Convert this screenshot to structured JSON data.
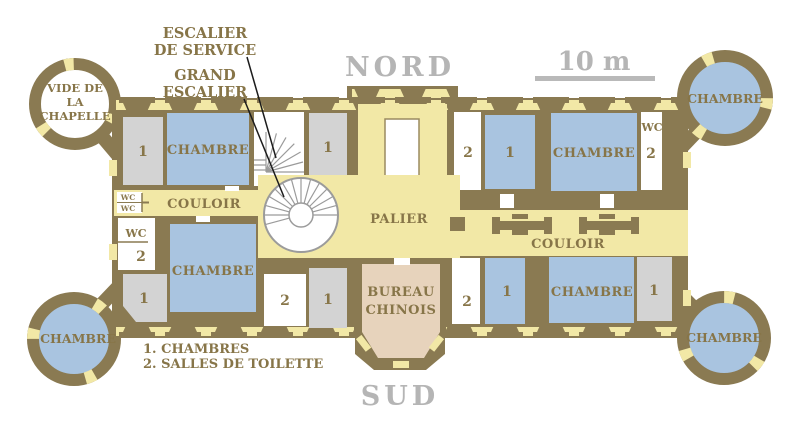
{
  "palette": {
    "wall": "#8a7a52",
    "corridor_yellow": "#f2e8a6",
    "chamber_blue": "#a9c4e0",
    "service_gray": "#d3d3d3",
    "bureau_beige": "#e7d3bc",
    "label_brown": "#877548",
    "annotation_gray": "#b5b5b5",
    "stair_gray": "#9b9b9b",
    "leader_black": "#1c1c1c"
  },
  "annotations": {
    "escalier_service": {
      "line1": "ESCALIER",
      "line2": "DE SERVICE"
    },
    "grand_escalier": {
      "line1": "GRAND",
      "line2": "ESCALIER"
    },
    "nord": "NORD",
    "sud": "SUD",
    "scale_label": "10 m",
    "legend": {
      "line1": "1. CHAMBRES",
      "line2": "2. SALLES DE TOILETTE"
    }
  },
  "rooms": {
    "chambre": "CHAMBRE",
    "couloir": "COULOIR",
    "palier": "PALIER",
    "bureau_chinois": {
      "line1": "BUREAU",
      "line2": "CHINOIS"
    },
    "vide_chapelle": {
      "line1": "VIDE DE",
      "line2": "LA",
      "line3": "CHAPELLE"
    },
    "wc": "WC",
    "num_chambre": "1",
    "num_toilette": "2"
  }
}
